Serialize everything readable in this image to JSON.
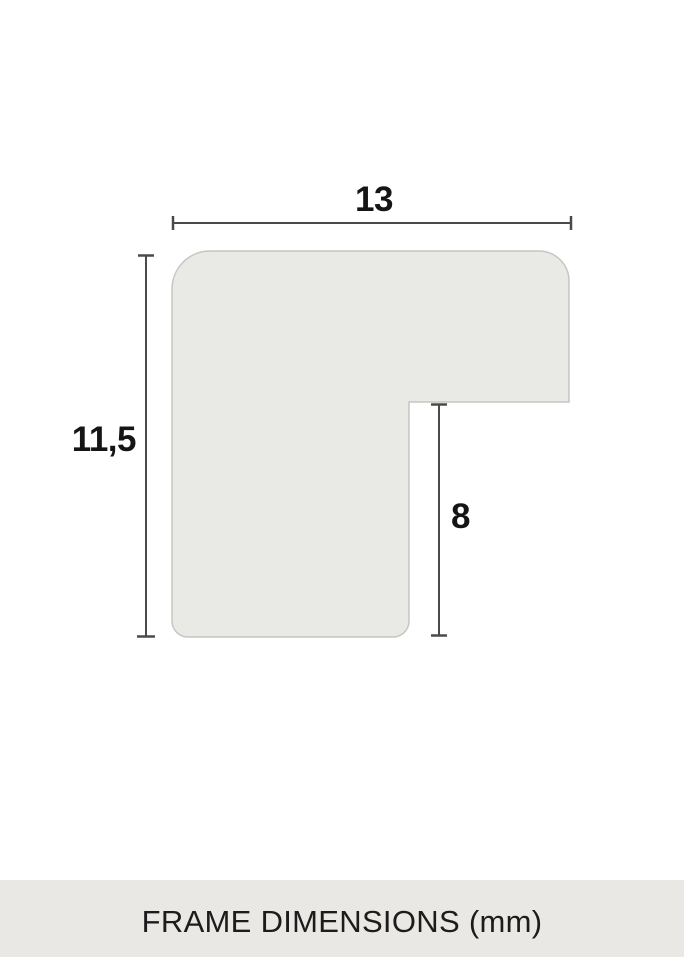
{
  "diagram": {
    "title": "frame moulding profile cross-section",
    "dimensions": {
      "width": {
        "label": "13"
      },
      "height": {
        "label": "11,5"
      },
      "rabbet": {
        "label": "8"
      }
    }
  },
  "footer": {
    "caption": "FRAME DIMENSIONS (mm)"
  },
  "colors": {
    "page_background": "#ffffff",
    "shape_fill": "#e9e9e5",
    "shape_border": "#c6c6c2",
    "dimension_line": "#4a4a4a",
    "label_text": "#151515",
    "footer_background": "#e9e8e4",
    "footer_text": "#1c1c1c"
  }
}
